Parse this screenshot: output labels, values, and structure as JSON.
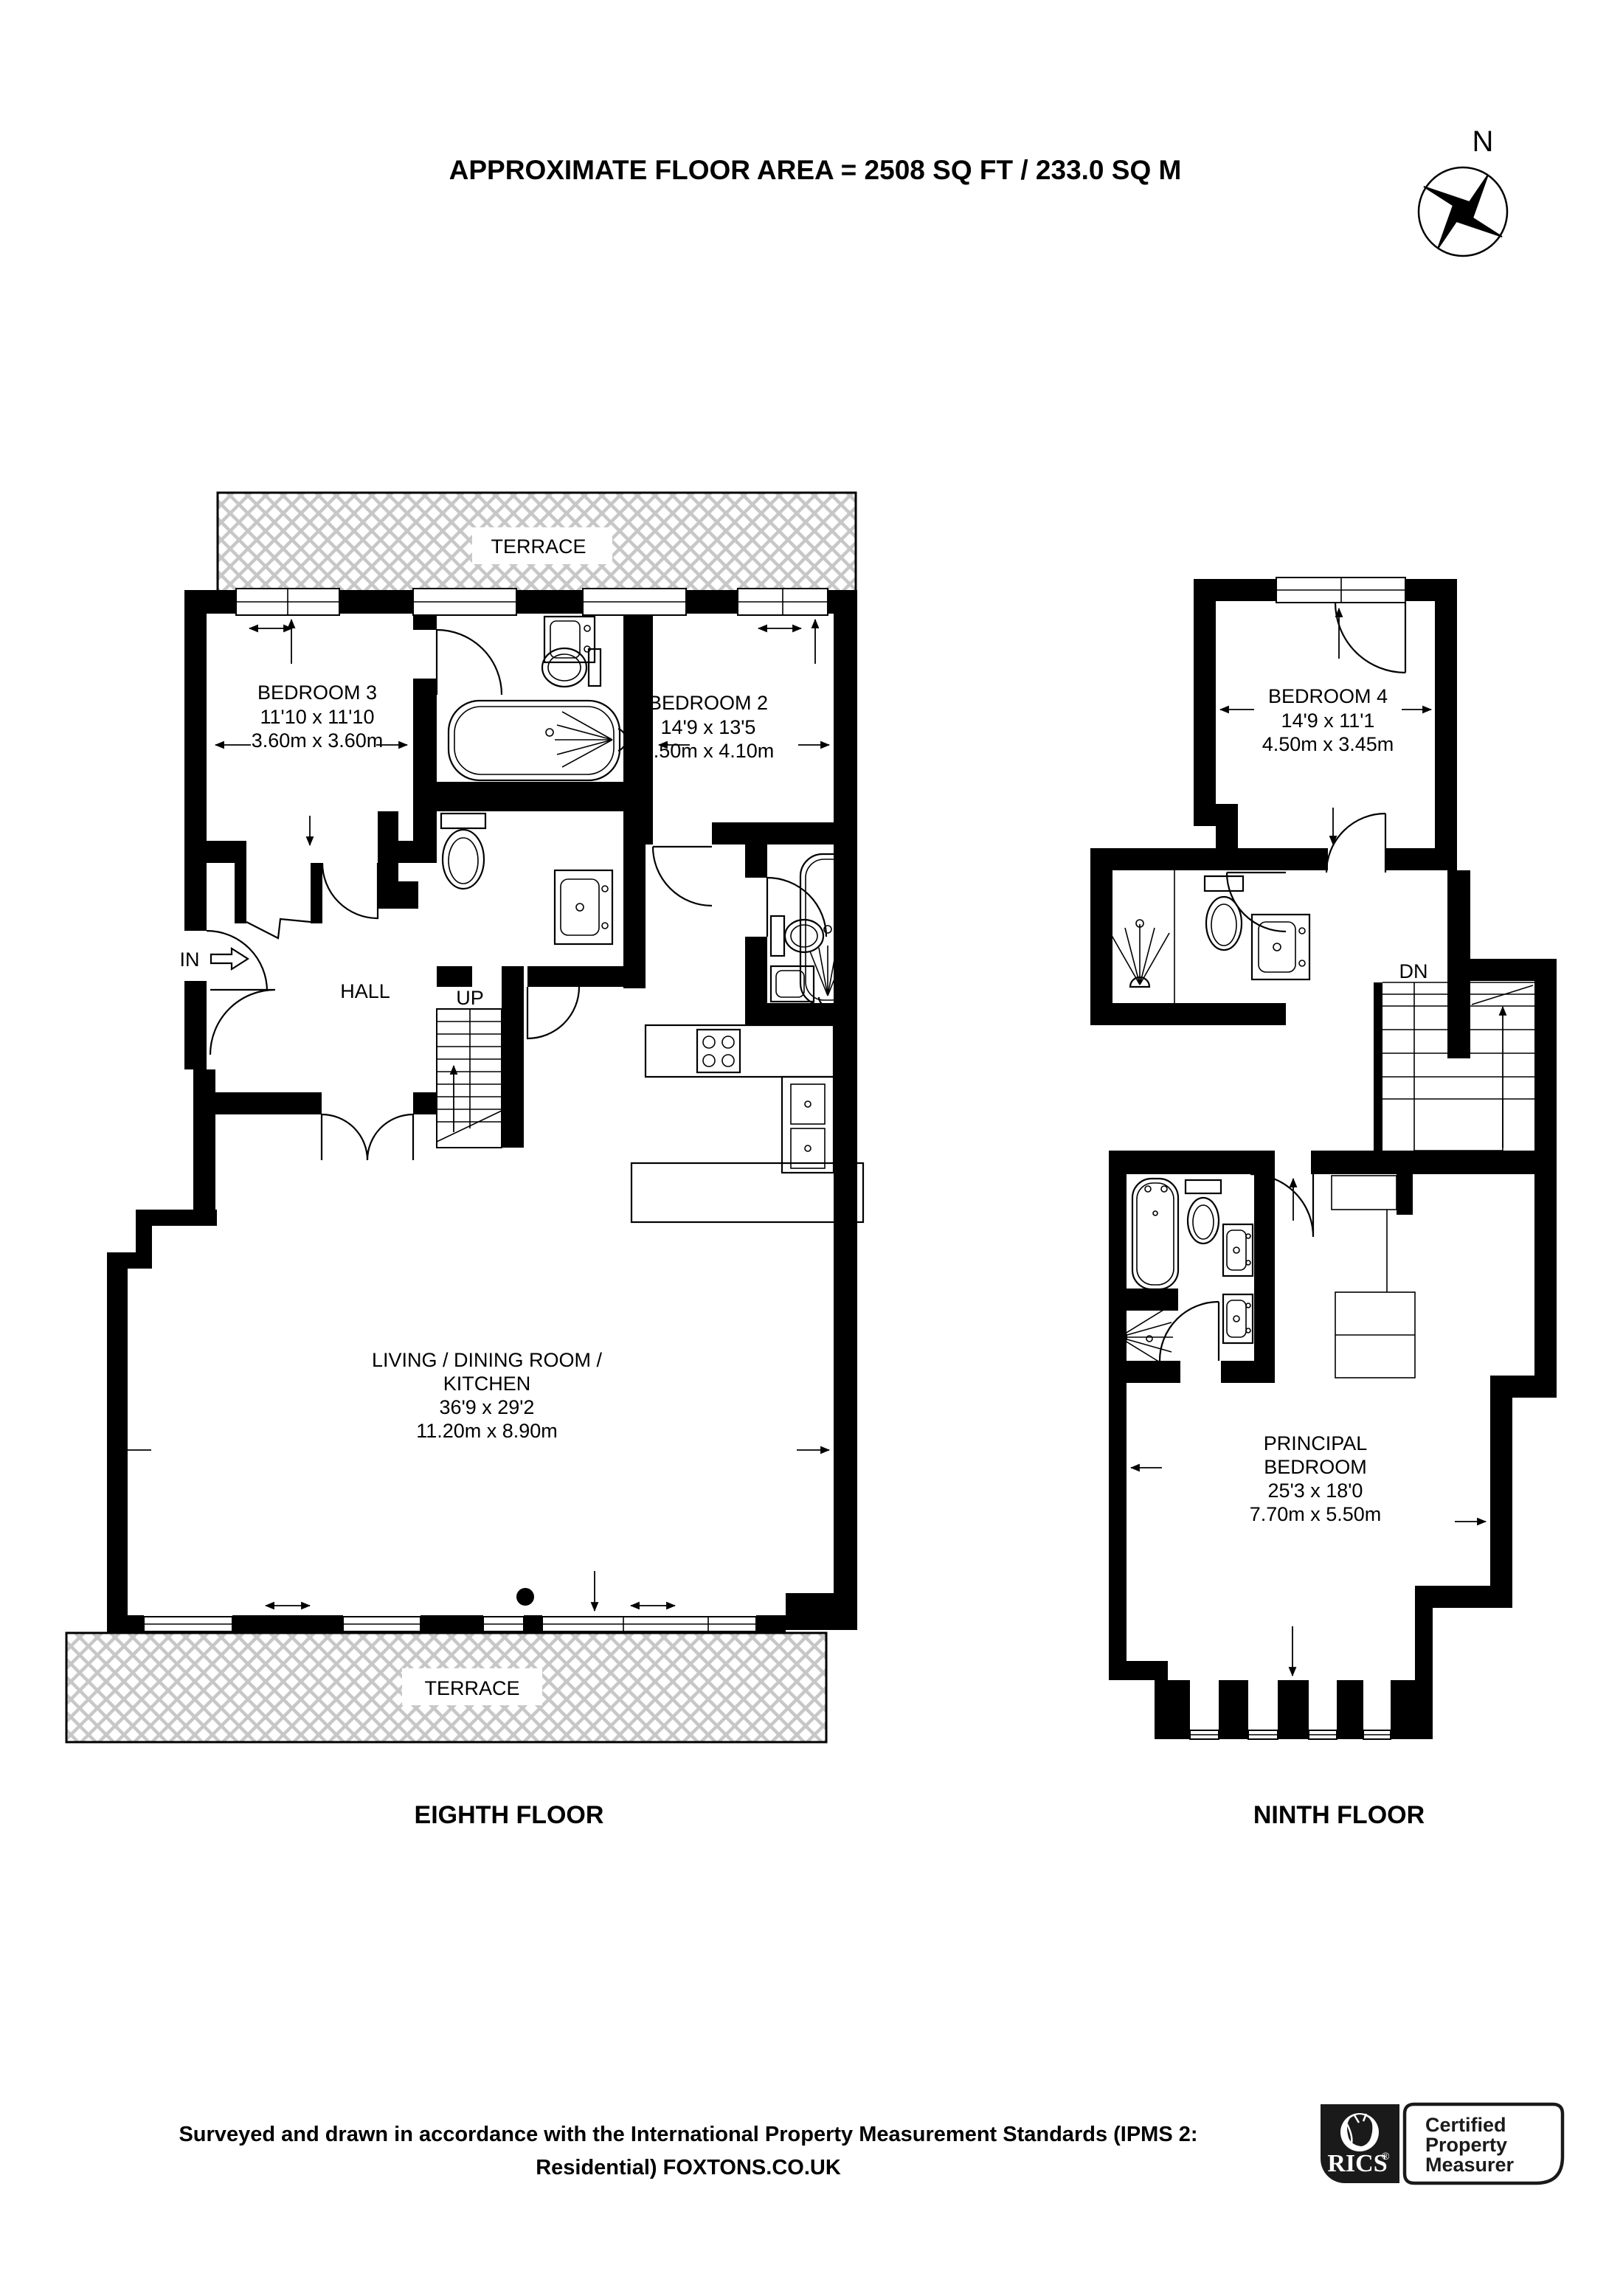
{
  "title": "APPROXIMATE FLOOR AREA = 2508 SQ FT / 233.0 SQ M",
  "compass": {
    "north": "N"
  },
  "eighth": {
    "label": "EIGHTH FLOOR",
    "terrace_top": "TERRACE",
    "terrace_bottom": "TERRACE",
    "hall": "HALL",
    "up": "UP",
    "in": "IN",
    "bedroom3": {
      "name": "BEDROOM 3",
      "imperial": "11'10 x 11'10",
      "metric": "3.60m x 3.60m"
    },
    "bedroom2": {
      "name": "BEDROOM 2",
      "imperial": "14'9 x 13'5",
      "metric": "4.50m x 4.10m"
    },
    "living": {
      "name1": "LIVING / DINING ROOM /",
      "name2": "KITCHEN",
      "imperial": "36'9 x 29'2",
      "metric": "11.20m x 8.90m"
    }
  },
  "ninth": {
    "label": "NINTH FLOOR",
    "dn": "DN",
    "bedroom4": {
      "name": "BEDROOM 4",
      "imperial": "14'9 x 11'1",
      "metric": "4.50m x 3.45m"
    },
    "principal": {
      "name1": "PRINCIPAL",
      "name2": "BEDROOM",
      "imperial": "25'3 x 18'0",
      "metric": "7.70m x 5.50m"
    }
  },
  "footer": {
    "line1": "Surveyed and drawn in accordance with the International Property Measurement Standards (IPMS 2:",
    "line2": "Residential) FOXTONS.CO.UK"
  },
  "badge": {
    "brand": "RICS",
    "registered": "®",
    "line1": "Certified",
    "line2": "Property",
    "line3": "Measurer"
  }
}
